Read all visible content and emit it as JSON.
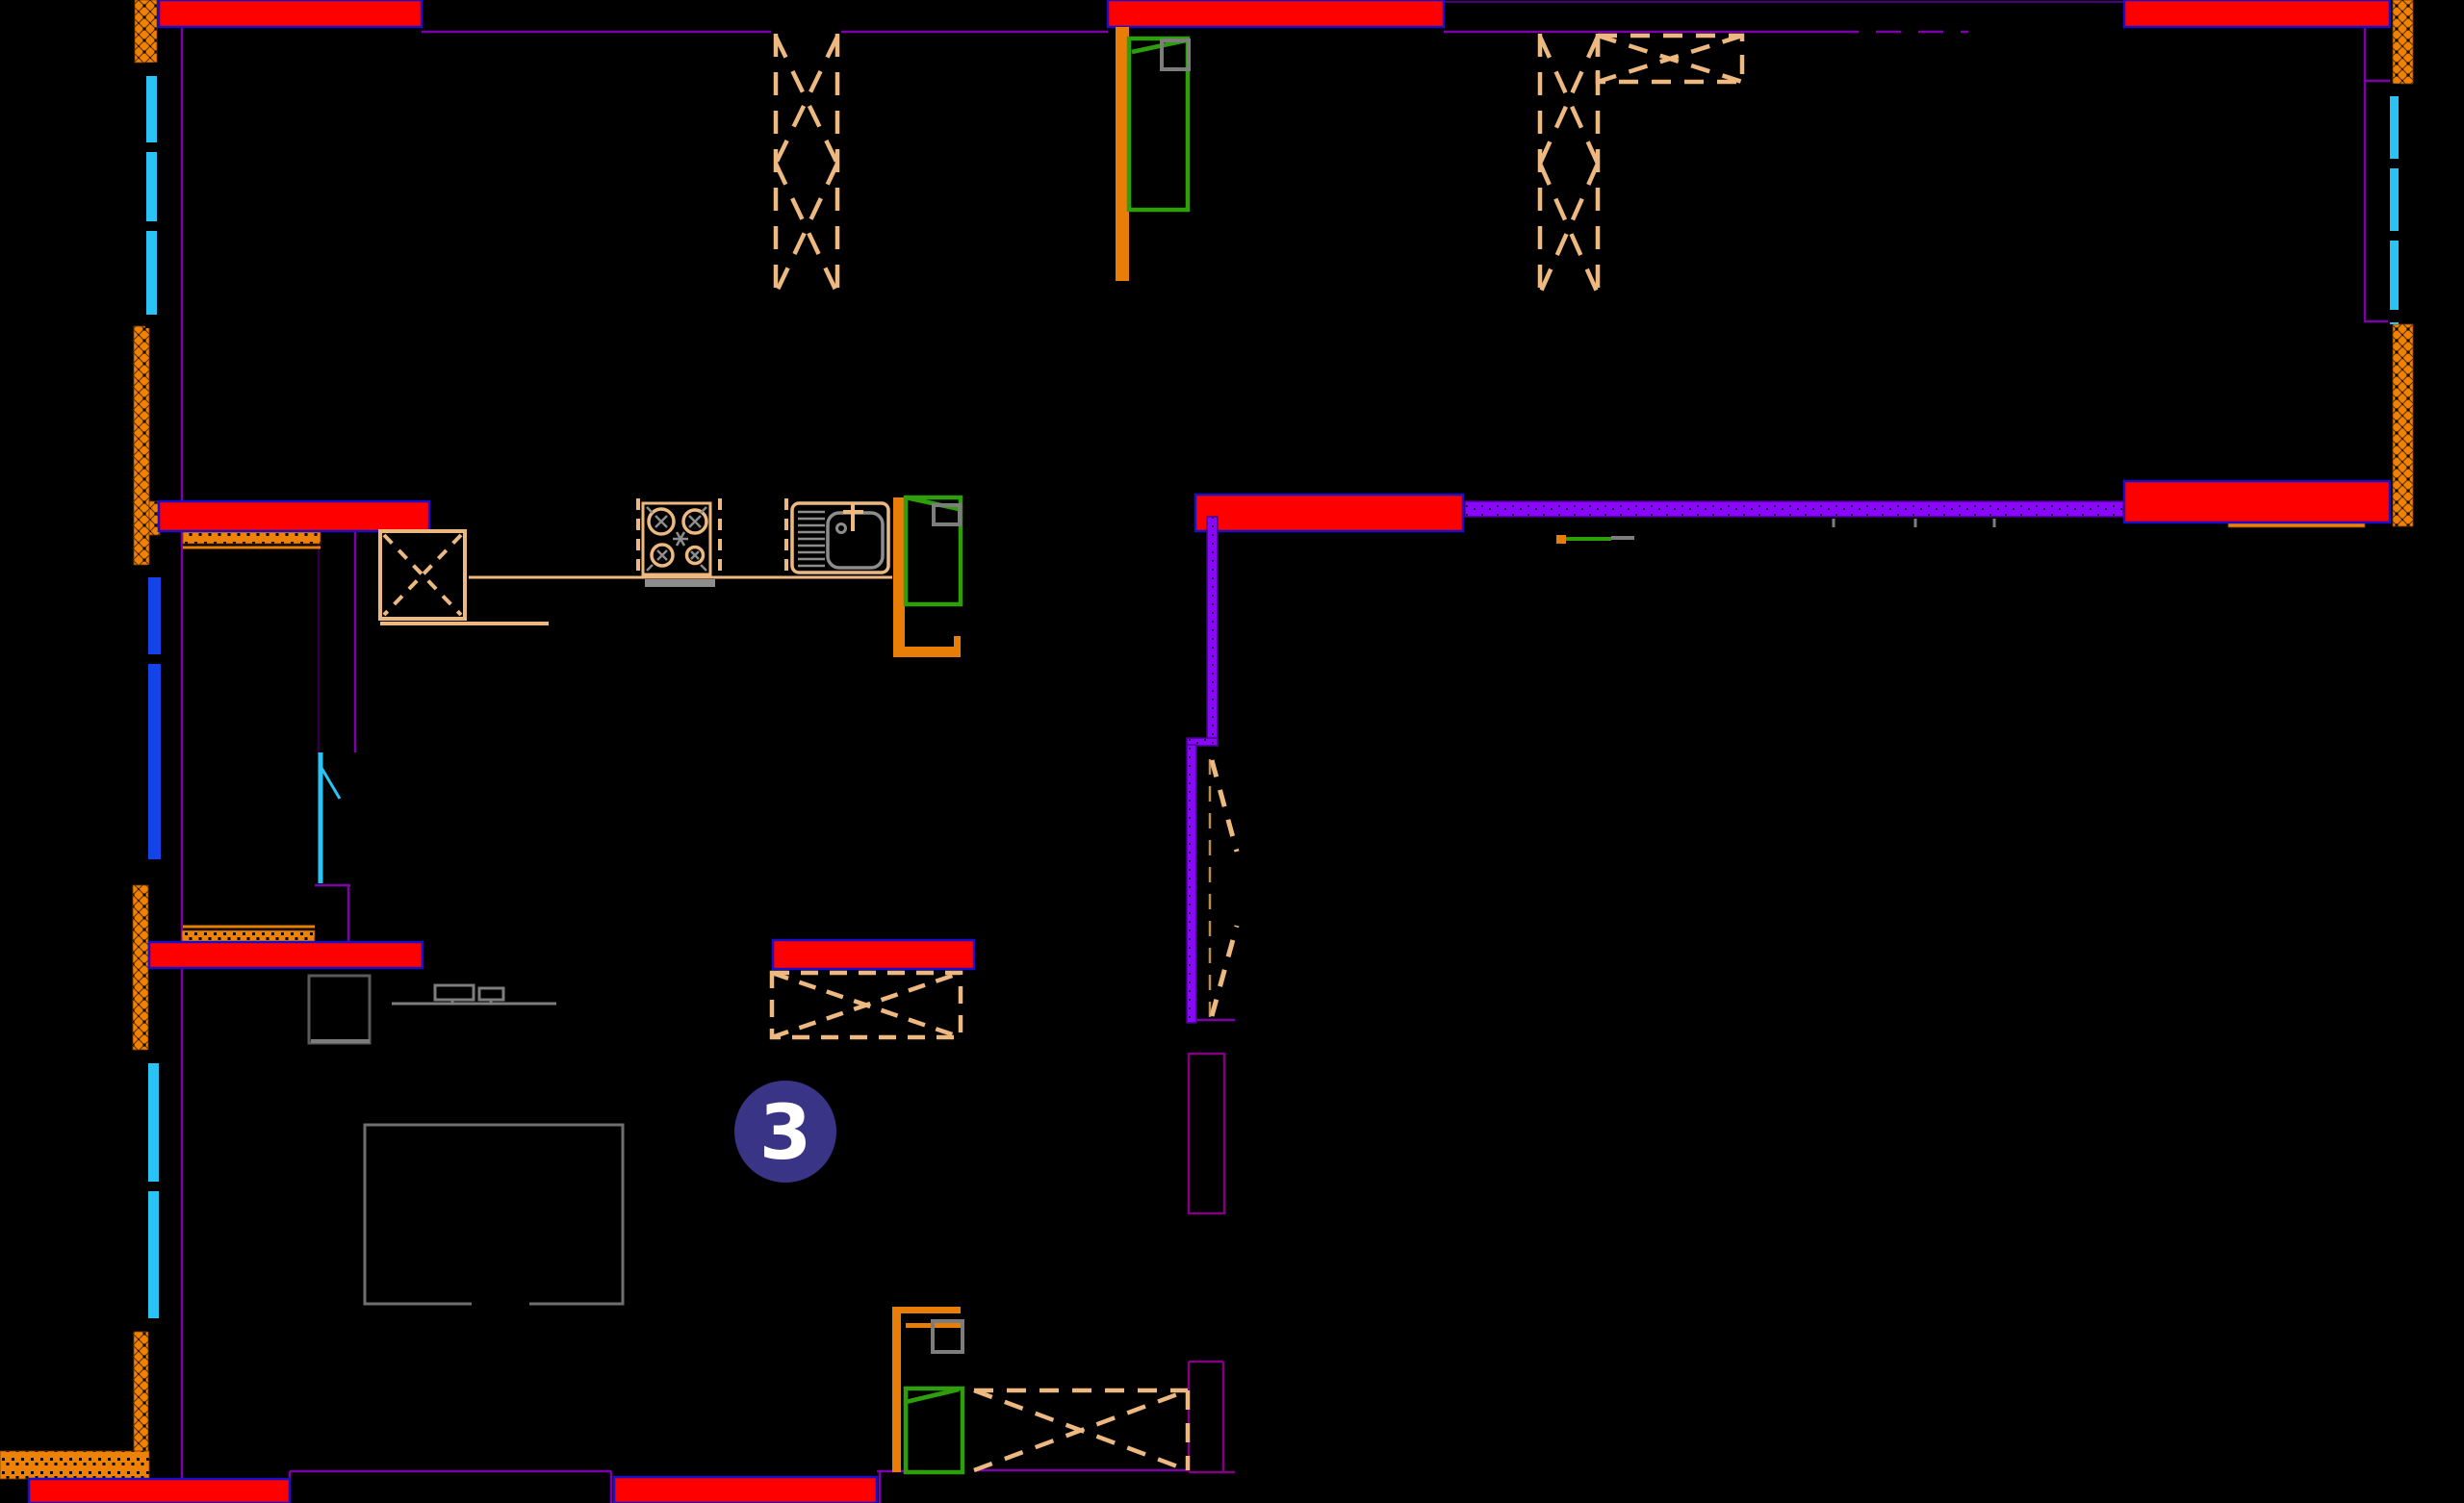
{
  "marker": {
    "label": "3"
  },
  "colors": {
    "bg": "#000000",
    "wall-red": "#fe0000",
    "wall-red-edge": "#1a10c8",
    "wall-violet": "#8a07fd",
    "line-purple": "#7d01a8",
    "line-darkpurple": "#4b0082",
    "hatch-orange": "#ef8104",
    "frame-orange": "#e87e08",
    "window-cyan": "#2ac3f5",
    "window-blue": "#1444e8",
    "door-green": "#2f9e0b",
    "dash-tan": "#edb980",
    "dash-tan-dark": "#b98a5a",
    "furniture-gray": "#7d7d7d",
    "furniture-gray-dark": "#5a5a5a",
    "marker-fill": "#3a3487",
    "marker-text": "#ffffff",
    "appliance-gray": "#8d8d8d"
  },
  "layers": {
    "red": "load-bearing-walls",
    "violet": "partition-walls",
    "orange": "insulation-and-door-frames",
    "cyan": "windows",
    "tan-dashed": "openings-and-shafts",
    "green": "door-leaves",
    "gray": "furniture-and-fixtures"
  }
}
